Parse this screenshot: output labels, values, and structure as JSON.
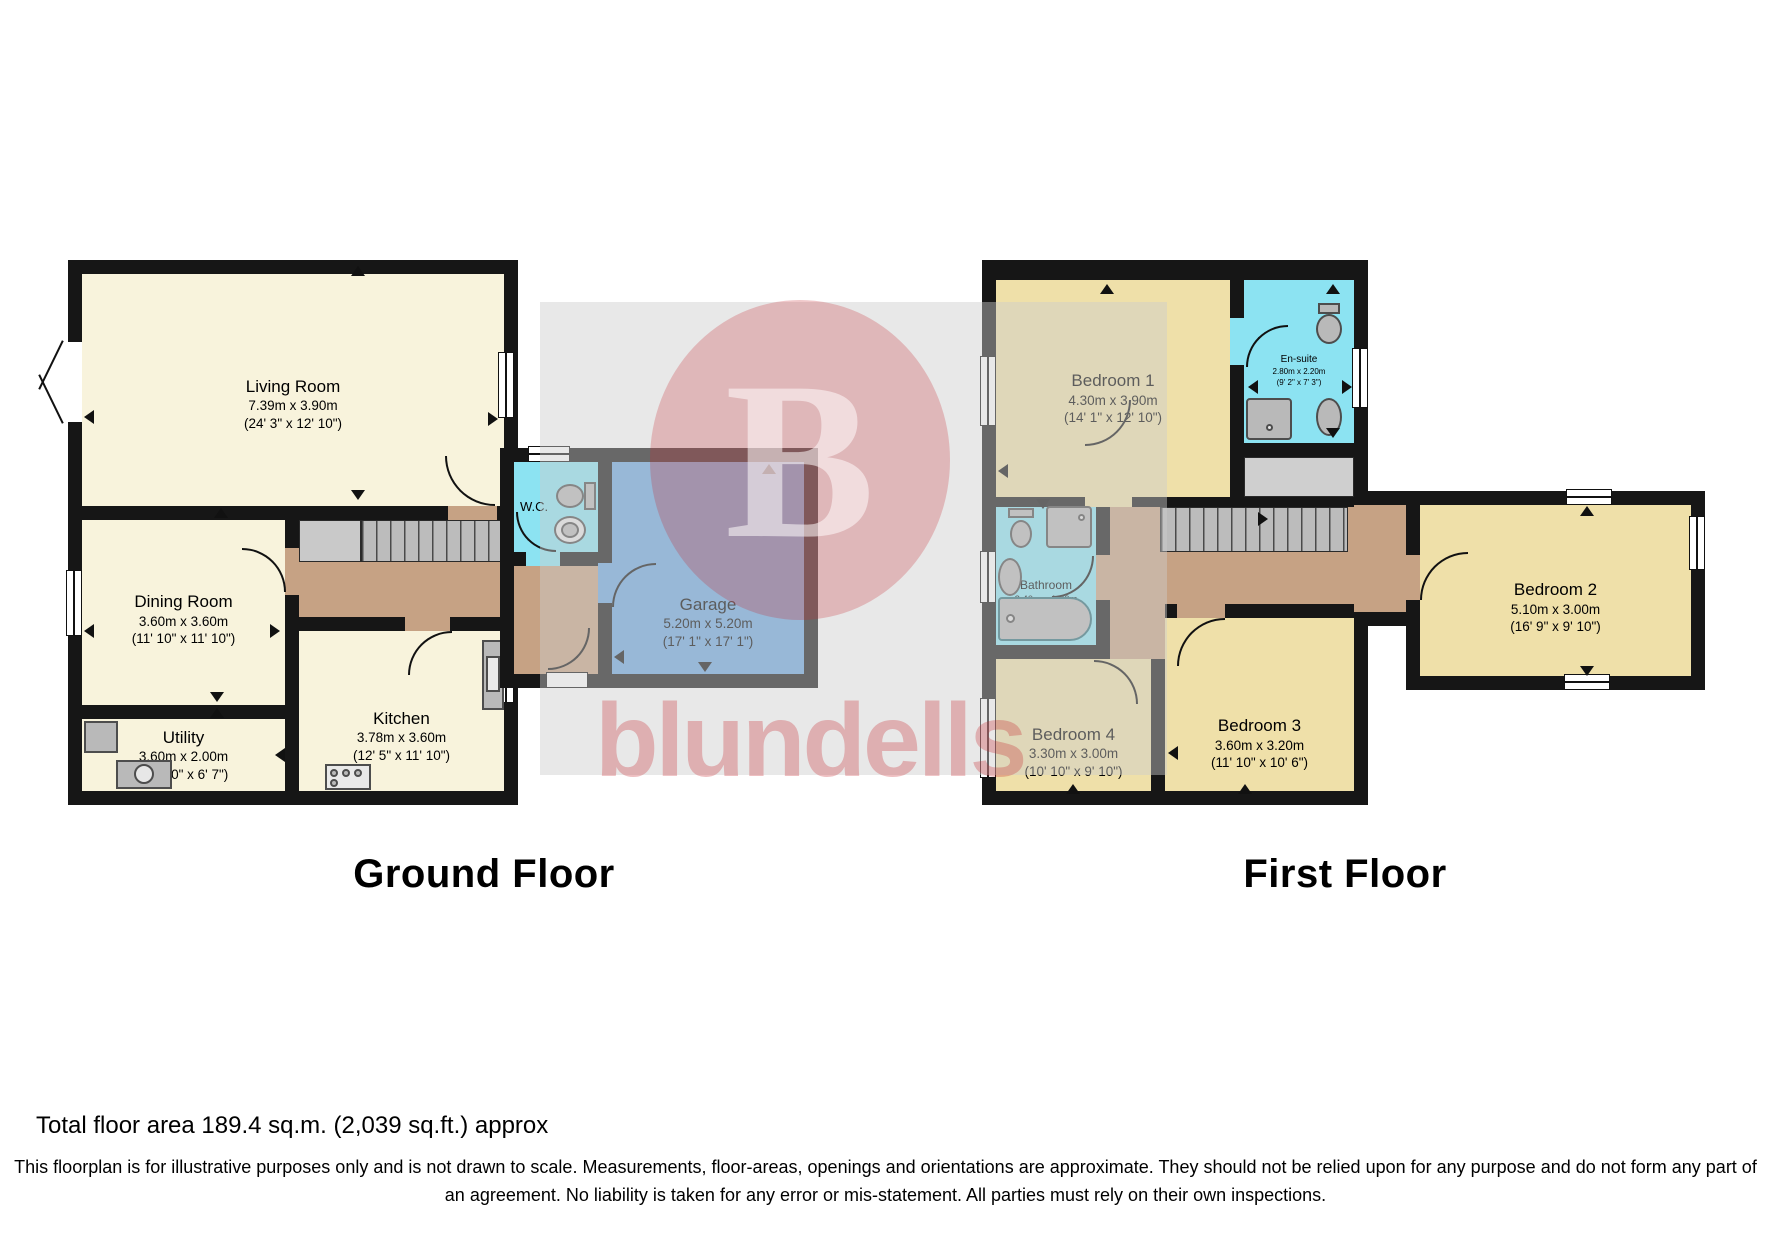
{
  "titles": {
    "ground": "Ground Floor",
    "first": "First Floor"
  },
  "rooms": {
    "living": {
      "name": "Living Room",
      "metric": "7.39m x 3.90m",
      "imperial": "(24' 3\" x 12' 10\")"
    },
    "dining": {
      "name": "Dining Room",
      "metric": "3.60m x 3.60m",
      "imperial": "(11' 10\" x 11' 10\")"
    },
    "utility": {
      "name": "Utility",
      "metric": "3.60m x 2.00m",
      "imperial": "(11' 10\" x 6' 7\")"
    },
    "kitchen": {
      "name": "Kitchen",
      "metric": "3.78m x 3.60m",
      "imperial": "(12' 5\" x 11' 10\")"
    },
    "wc": {
      "name": "W.C."
    },
    "garage": {
      "name": "Garage",
      "metric": "5.20m x 5.20m",
      "imperial": "(17' 1\" x 17' 1\")"
    },
    "bedroom1": {
      "name": "Bedroom 1",
      "metric": "4.30m x 3.90m",
      "imperial": "(14' 1\" x 12' 10\")"
    },
    "ensuite": {
      "name": "En-suite",
      "metric": "2.80m x 2.20m",
      "imperial": "(9' 2\" x 7' 3\")"
    },
    "bathroom": {
      "name": "Bathroom",
      "metric": "2.40m x 1.80m",
      "imperial": "(7' 10\" x 5' 11\")"
    },
    "bedroom2": {
      "name": "Bedroom 2",
      "metric": "5.10m x 3.00m",
      "imperial": "(16' 9\" x 9' 10\")"
    },
    "bedroom3": {
      "name": "Bedroom 3",
      "metric": "3.60m x 3.20m",
      "imperial": "(11' 10\" x 10' 6\")"
    },
    "bedroom4": {
      "name": "Bedroom 4",
      "metric": "3.30m x 3.00m",
      "imperial": "(10' 10\" x 9' 10\")"
    }
  },
  "watermark": {
    "logo_letter": "B",
    "brand": "blundells"
  },
  "footer": {
    "total": "Total floor area 189.4 sq.m. (2,039 sq.ft.) approx",
    "disclaimer": "This floorplan is for illustrative purposes only and is not drawn to scale. Measurements, floor-areas, openings and orientations are approximate. They should not be relied upon for any purpose and do not form any part of an agreement. No liability is taken for any error or mis-statement. All parties must rely on their own inspections."
  },
  "colors": {
    "wall": "#161616",
    "room_cream": "#f8f3dc",
    "room_gold": "#efe0a9",
    "wet_cyan": "#8ce3f2",
    "garage_blue": "#6da8e0",
    "hall_tan": "#c6a284",
    "stair_gray": "#bcbcbc",
    "brand_red": "#c62a32"
  }
}
